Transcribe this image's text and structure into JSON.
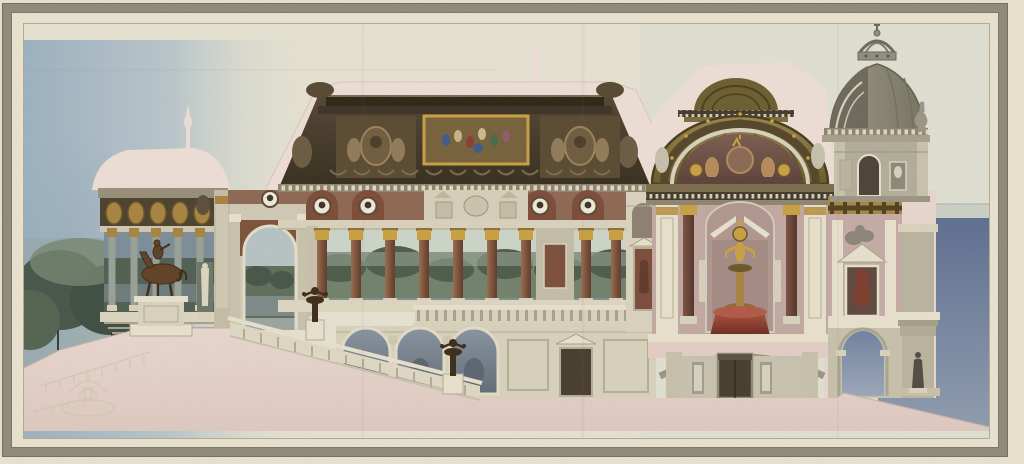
{
  "artwork": {
    "type": "watercolor-architectural-section",
    "description": "Watercolour longitudinal cross-section of a grand neoclassical palace: left open loggia with bronze equestrian statue, great gallery with painted cove ceiling and red-marble colonnade over a basement arcade, grand staircase with candelabra, central gilded half-dome shrine room with statue on red pedestal, right wing with domed corner tower, terrace and blue-grey sky, on cream paper with grey ruled border",
    "elements": [
      "sky",
      "trees",
      "pencil-sketch-fountain",
      "left-loggia",
      "equestrian-statue",
      "great-hall",
      "ceiling-painting",
      "medallion-frieze",
      "colonnade",
      "basement-arcade",
      "grand-staircase",
      "candelabra",
      "central-pavilion",
      "gilded-half-dome",
      "shrine-statue",
      "red-pedestal",
      "right-wing",
      "open-archway",
      "terrace-figure",
      "right-tower",
      "crown-lantern",
      "urn-finial",
      "ground-poche",
      "paper-frame"
    ]
  },
  "palette": {
    "paper": "#e9e3cf",
    "field": "#ece6d2",
    "band": "#8e8b7b",
    "band_dark": "#6e6c5e",
    "inner_line": "#b2aa93",
    "poche": "#eedfd6",
    "poche_deep": "#e3cec6",
    "ground_pink": "#e7d3ca",
    "ground_pink_deep": "#dcc4bb",
    "sky_left": "#9cb1c1",
    "sky_left_mid": "#b9c6cc",
    "sky_right": "#e0e0d3",
    "sky_blue": "#5c6d90",
    "sky_blue_light": "#8e9cb0",
    "horizon": "#c6ccc4",
    "tree_dark": "#445448",
    "tree_mid": "#5d6d58",
    "tree_pale": "#74846f",
    "mist": "#8fa095",
    "dusk": "#7b8d99",
    "dusk_deep": "#54666f",
    "stone": "#d9d3be",
    "stone_light": "#e7e1cd",
    "stone_warm": "#c7c1ab",
    "stone_shadow": "#a8a28b",
    "attic_dark": "#42382a",
    "attic_deep": "#2c2413",
    "panel_brown": "#584830",
    "painting_bg": "#75603a",
    "gold": "#c9a041",
    "gold_deep": "#6b5426",
    "gold_soft": "#a8833f",
    "frieze_red": "#8d6753",
    "arch_red": "#7b4a37",
    "medallion": "#efead9",
    "bust": "#3c2f23",
    "column_red": "#8a5742",
    "column_dark": "#5f4033",
    "marble_grey": "#98a096",
    "mural_blue": "#8893a0",
    "mural_deep": "#5f6a76",
    "bronze": "#5e3f22",
    "bronze_dark": "#3a2916",
    "red_ped": "#9a4434",
    "red_ped_deep": "#69271d",
    "mauve": "#c2a8a2",
    "mauve_deep": "#ab8e88",
    "dome_gold": "#8b7840",
    "dome_gold_deep": "#64562b",
    "lunette": "#6e5045",
    "dome_grey": "#908d7c",
    "dome_grey_deep": "#6b6859",
    "tower_stone": "#b3ad9a",
    "door_dark": "#453b2c",
    "fig_dark": "#4f4a40",
    "sketch": "#cfc8b2"
  }
}
